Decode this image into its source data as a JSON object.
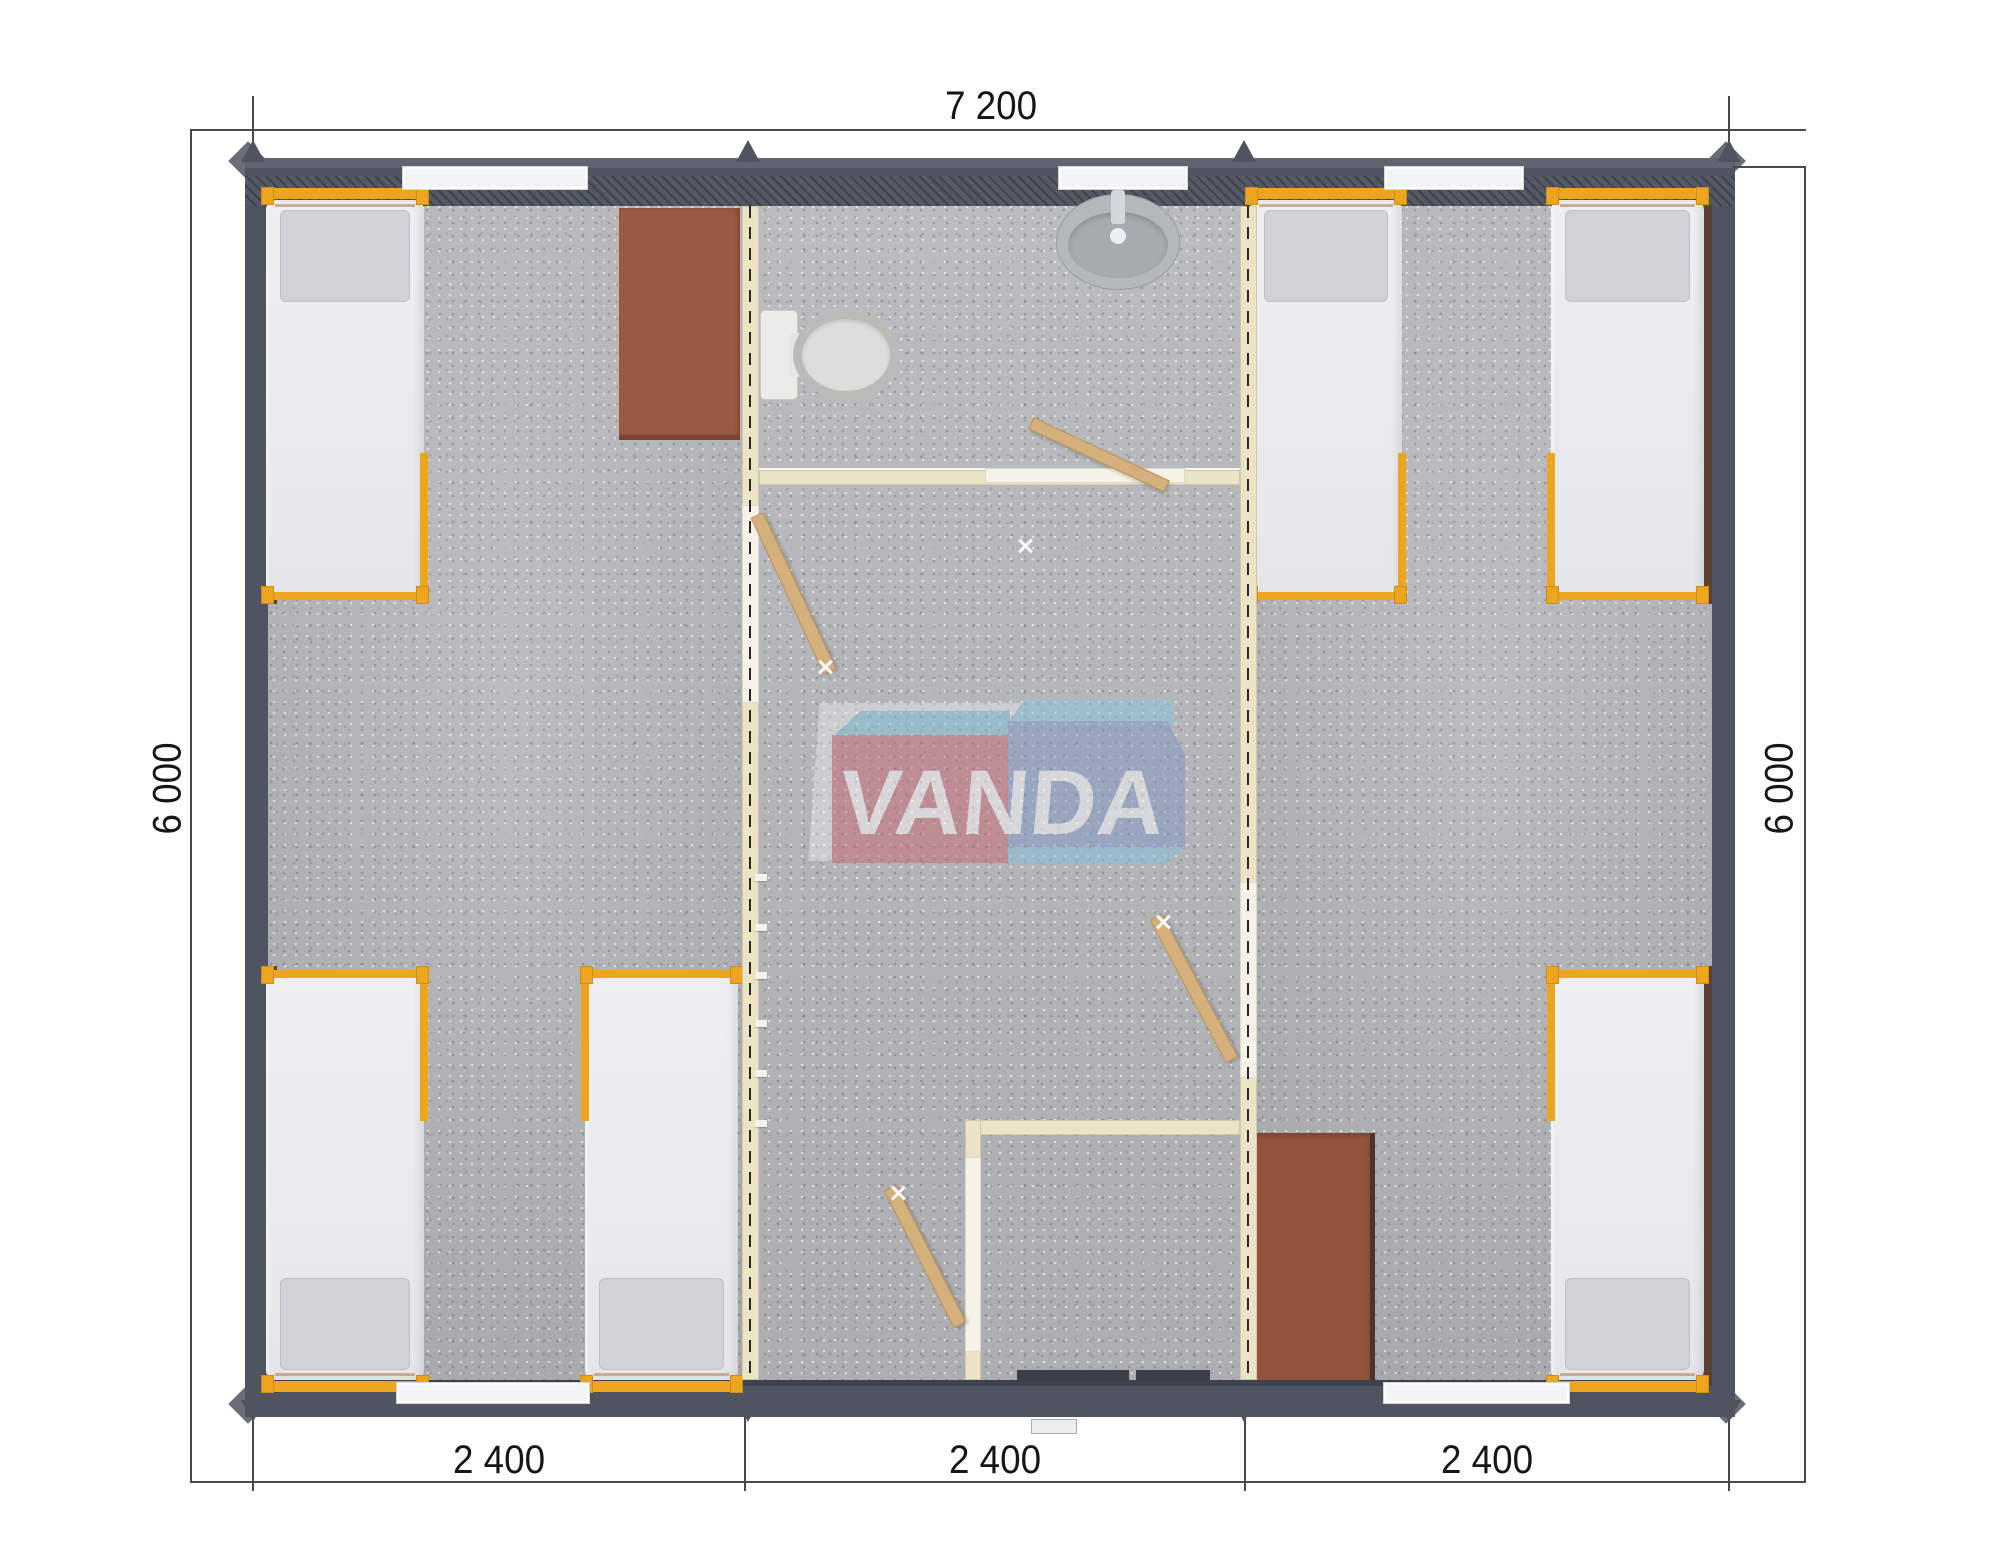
{
  "page": {
    "title": "VANDA modular building floor plan",
    "background": "#ffffff"
  },
  "watermark": {
    "text": "VANDA",
    "red_box_color": "#c96570",
    "blue_box_color": "#8198c4",
    "light_blue_color": "#85c3de",
    "text_color": "#ffffff"
  },
  "dimensions": {
    "top": "7 200",
    "left": "6 000",
    "right": "6 000",
    "bottom_segments": [
      "2 400",
      "2 400",
      "2 400"
    ]
  },
  "plan": {
    "modules": 3,
    "rooms": [
      {
        "name": "left-bedroom",
        "beds": 3,
        "desks": 1
      },
      {
        "name": "bathroom",
        "fixtures": [
          "toilet",
          "washbasin"
        ]
      },
      {
        "name": "hallway",
        "interior_doors": 4
      },
      {
        "name": "entry-vestibule",
        "entrance_door": true
      },
      {
        "name": "right-bedroom",
        "beds": 3,
        "desks": 1
      }
    ],
    "furniture_totals": {
      "beds": 6,
      "desks": 2,
      "windows": 5
    },
    "colors": {
      "outer_wall": "#4f5460",
      "interior_wall": "#ebe3c6",
      "floor": "#b6b7bb",
      "bed_frame": "#eda51f",
      "mattress": "#e9ebee",
      "desk": "#9b5941",
      "door_leaf": "#d4b07c"
    }
  }
}
